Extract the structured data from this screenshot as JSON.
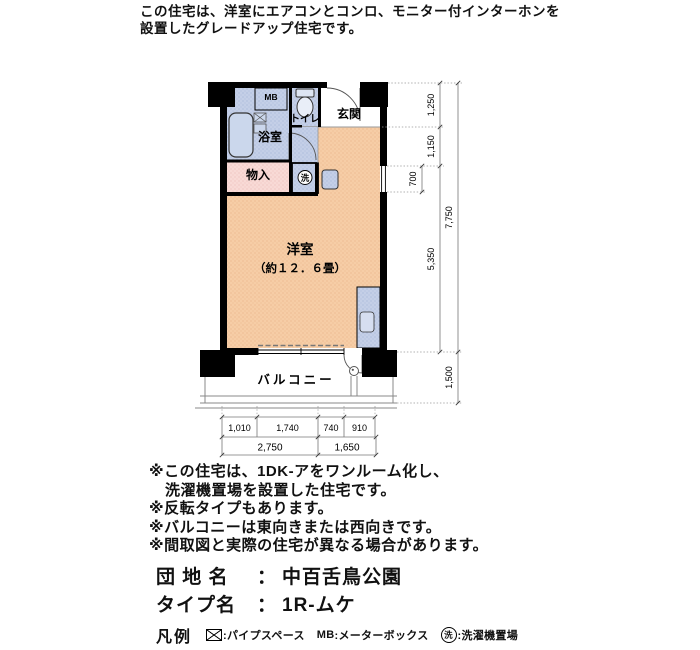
{
  "header": {
    "line1": "この住宅は、洋室にエアコンとコンロ、モニター付インターホンを",
    "line2": "設置したグレードアップ住宅です。"
  },
  "plan": {
    "labels": {
      "mb": "MB",
      "toilet": "トイレ",
      "entrance": "玄関",
      "bathroom": "浴室",
      "storage": "物入",
      "washer": "洗",
      "room": "洋室",
      "room_size": "（約１２．６畳）",
      "balcony": "バルコニー"
    },
    "dims_right": {
      "d1250": "1,250",
      "d1150": "1,150",
      "d700": "700",
      "d5350": "5,350",
      "d7750": "7,750",
      "d1500": "1,500"
    },
    "dims_bottom_upper": {
      "d1010": "1,010",
      "d1740": "1,740",
      "d740": "740",
      "d910": "910"
    },
    "dims_bottom_lower": {
      "d2750": "2,750",
      "d1650": "1,650"
    }
  },
  "notes": {
    "line1": "※この住宅は、1DK-アをワンルーム化し、",
    "line2": "洗濯機置場を設置した住宅です。",
    "line3": "※反転タイプもあります。",
    "line4": "※バルコニーは東向きまたは西向きです。",
    "line5": "※間取図と実際の住宅が異なる場合があります。"
  },
  "footer": {
    "estate_label": "団 地 名",
    "separator": "：",
    "estate_name": "中百舌鳥公園",
    "type_label": "タイプ名",
    "type_name": "1R-ムケ",
    "legend_title": "凡例",
    "legend": {
      "pipe_text": ":パイプスペース",
      "mb_symbol": "MB",
      "mb_text": ":メーターボックス",
      "washer_symbol": "洗",
      "washer_text": ":洗濯機置場"
    }
  },
  "colors": {
    "room": "#F6CDA6",
    "wet_area": "#C4CFE7",
    "storage": "#F8DAD6",
    "wall": "#000000"
  }
}
